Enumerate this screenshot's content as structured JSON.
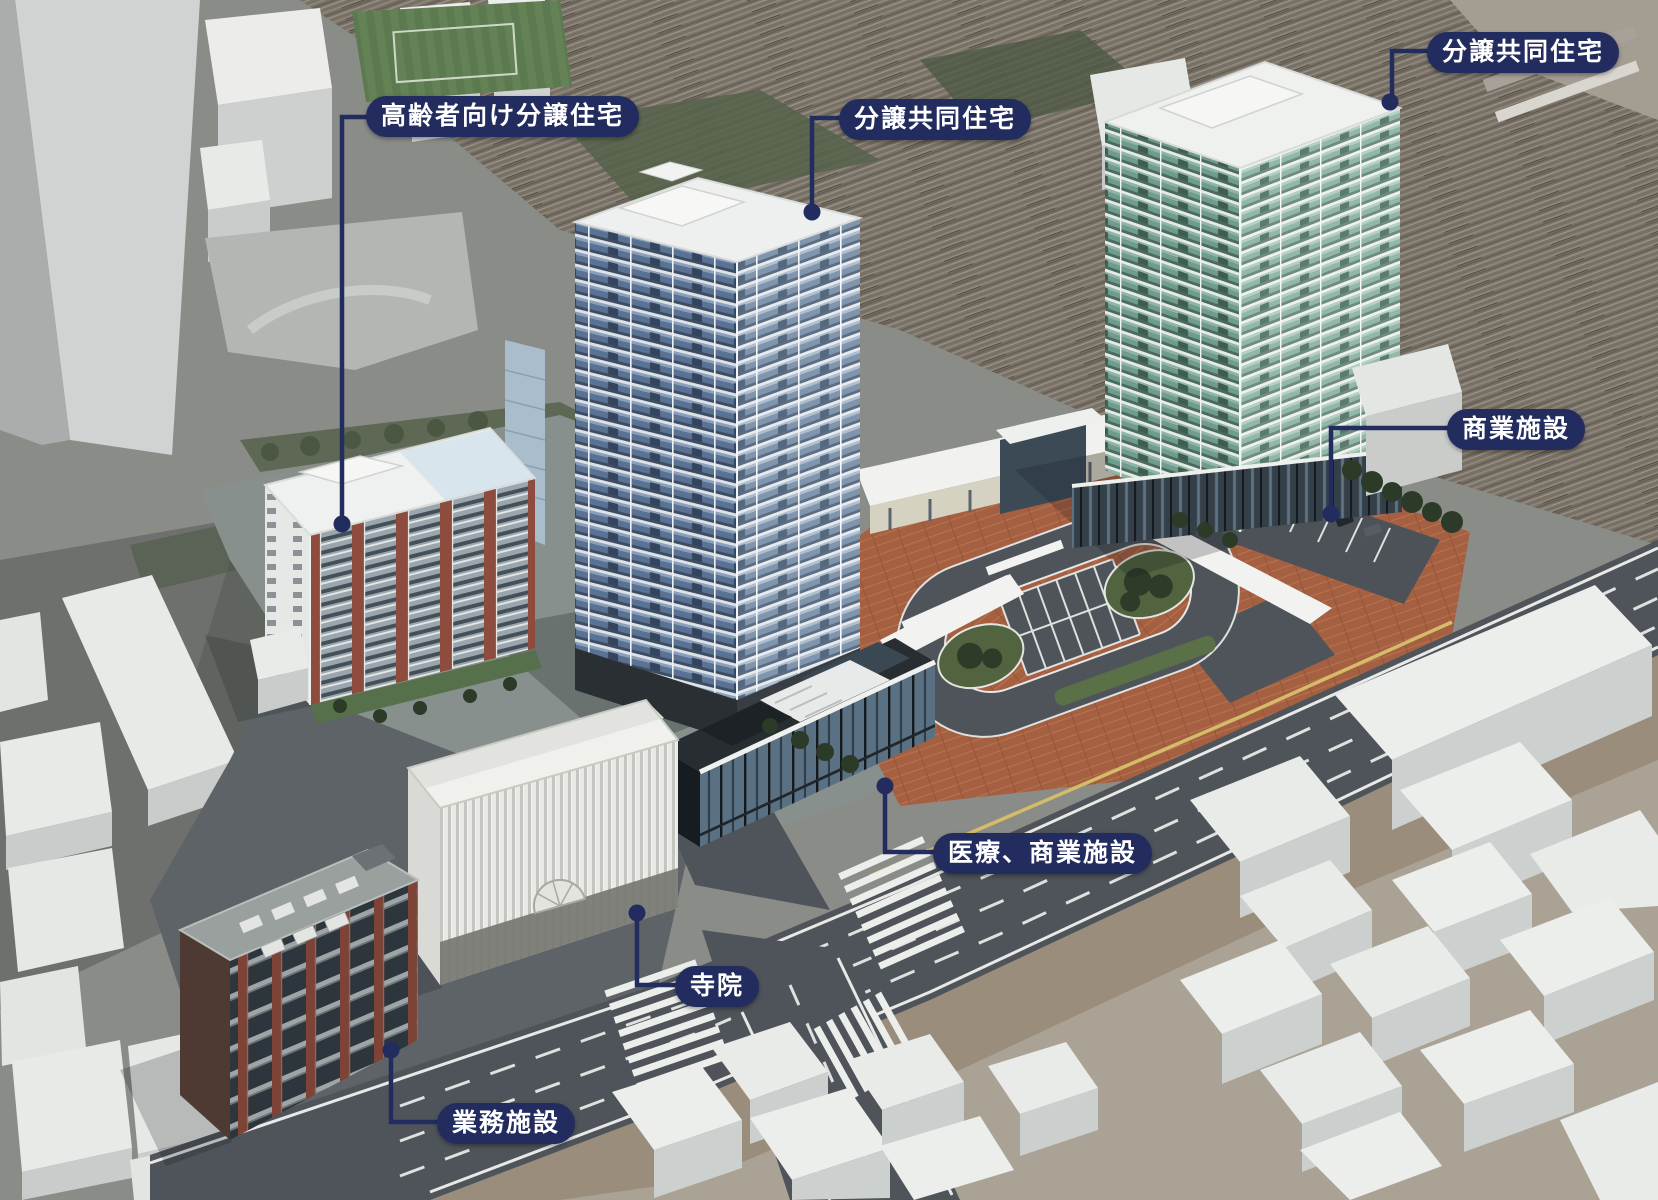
{
  "colors": {
    "label_bg": "#232c5e",
    "label_text": "#ffffff",
    "leader": "#232c5e",
    "yellow_line": "#d4bc6a",
    "brick_paving": "#a55f41",
    "asphalt": "#4e545a",
    "canopy_white": "#f2f3f0"
  },
  "labels": [
    {
      "id": "senior-housing",
      "text": "高齢者向け分譲住宅"
    },
    {
      "id": "condo-center",
      "text": "分譲共同住宅"
    },
    {
      "id": "condo-right",
      "text": "分譲共同住宅"
    },
    {
      "id": "commercial",
      "text": "商業施設"
    },
    {
      "id": "medical-commercial",
      "text": "医療、商業施設"
    },
    {
      "id": "temple",
      "text": "寺院"
    },
    {
      "id": "office",
      "text": "業務施設"
    }
  ]
}
